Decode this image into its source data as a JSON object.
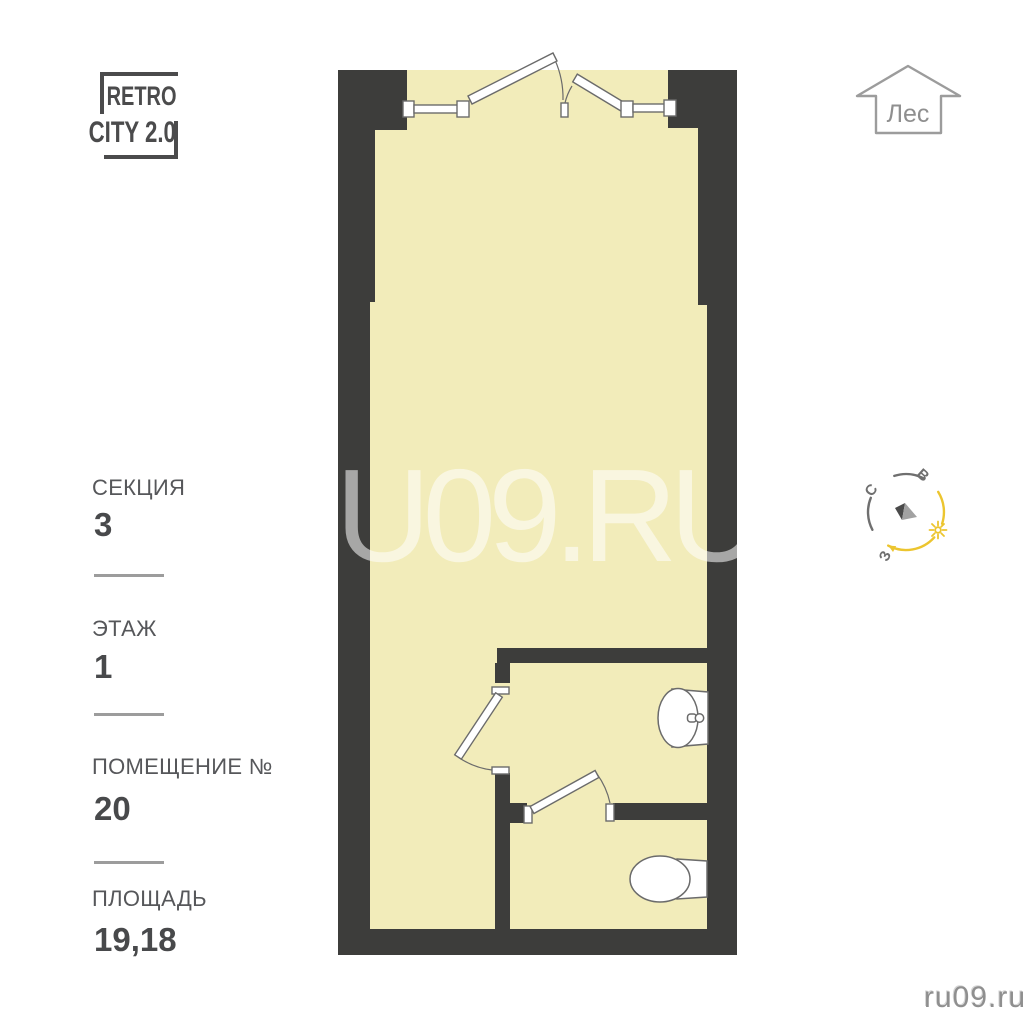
{
  "logo": {
    "line1": "RETRO",
    "line2": "CITY 2.0"
  },
  "direction_marker": {
    "label": "Лес"
  },
  "compass": {
    "north": "С",
    "east": "В",
    "west": "З"
  },
  "info_panel": {
    "section": {
      "label": "СЕКЦИЯ",
      "value": "3"
    },
    "floor": {
      "label": "ЭТАЖ",
      "value": "1"
    },
    "unit": {
      "label": "ПОМЕЩЕНИЕ №",
      "value": "20"
    },
    "area": {
      "label": "ПЛОЩАДЬ",
      "value": "19,18"
    }
  },
  "watermark": "RU09.RU",
  "site_credit": "ru09.ru",
  "colors": {
    "wall": "#3d3d3b",
    "floor": "#f2ecba",
    "fixture_outline": "#6b6b6b",
    "accent_yellow": "#ecc52f",
    "compass_gray": "#6f6f6f",
    "watermark_white": "rgba(255,255,255,0.55)"
  }
}
